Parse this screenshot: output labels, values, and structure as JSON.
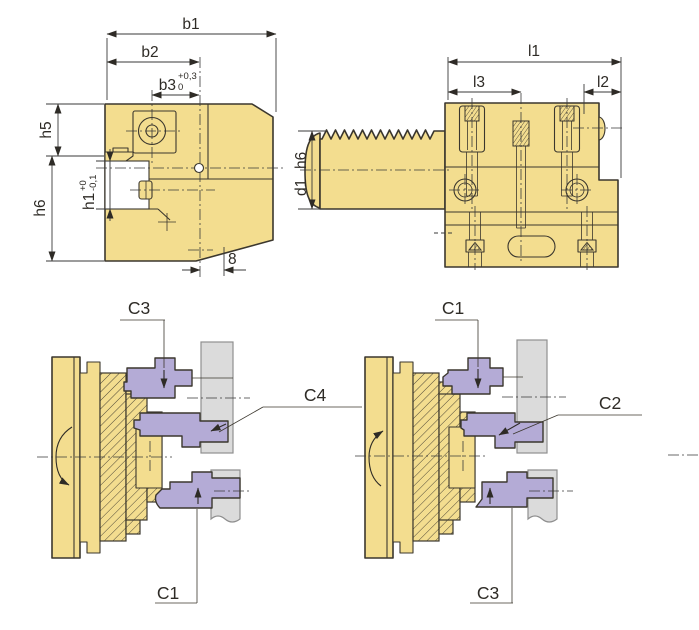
{
  "drawing": {
    "type": "technical-drawing-tool-holder",
    "colors": {
      "body": "#F3DD8F",
      "tool": "#B4ABD6",
      "workpiece": "#DBDBDB",
      "line": "#3B372E"
    }
  },
  "front_view": {
    "b1": "b1",
    "b2": "b2",
    "b3": "b3",
    "b3_tol_upper": "+0,3",
    "b3_tol_lower": "0",
    "h5": "h5",
    "h6": "h6",
    "h1": "h1",
    "h1_tol_upper": "+0",
    "h1_tol_lower": "-0,1",
    "chamfer": "8"
  },
  "side_view": {
    "l1": "l1",
    "l2": "l2",
    "l3": "l3",
    "shank_dia": "d1",
    "shank_tol": "h6"
  },
  "left_diagram": {
    "top_label": "C3",
    "middle_label": "C4",
    "bottom_label": "C1"
  },
  "right_diagram": {
    "top_label": "C1",
    "middle_label": "C2",
    "bottom_label": "C3"
  }
}
